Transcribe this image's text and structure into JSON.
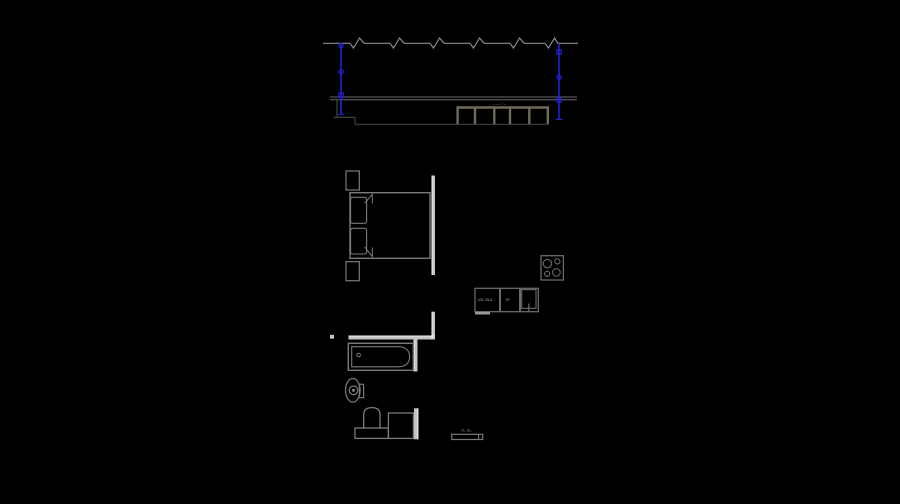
{
  "app": {
    "name": "cad-floorplan-drawing",
    "background": "#000000"
  },
  "colors": {
    "background": "#000000",
    "dimension_blue": "#2222d6",
    "break_line_gray": "#8a8a8a",
    "section_line_gray": "#6a6a6a",
    "step_line_dark": "#4a4a4a",
    "cabinet_gray": "#6e6959",
    "wall_fill": "#c4c4c4",
    "wall_edge": "#f2f2f2",
    "fixture_gray": "#7a7a7a",
    "tiny_text_gray": "#8f8f8f"
  },
  "elevation": {
    "name": "wall-section-with-cabinet-row",
    "cabinet_sections": 5,
    "break_symbols": 6,
    "dimension_lines": 2,
    "marks_label": "╌╌╌┆╌"
  },
  "plan": {
    "rooms": [
      "bedroom",
      "bathroom",
      "kitchen"
    ],
    "fixtures": [
      "bed",
      "nightstand-top",
      "nightstand-bottom",
      "bathtub",
      "toilet",
      "pedestal-sink",
      "washing-machine",
      "kitchen-counter",
      "kitchen-sink",
      "cooktop",
      "radiator"
    ],
    "labels": {
      "counter_left": "LED.SALD.",
      "counter_mid": "TM",
      "radiator": "st.dv."
    }
  }
}
